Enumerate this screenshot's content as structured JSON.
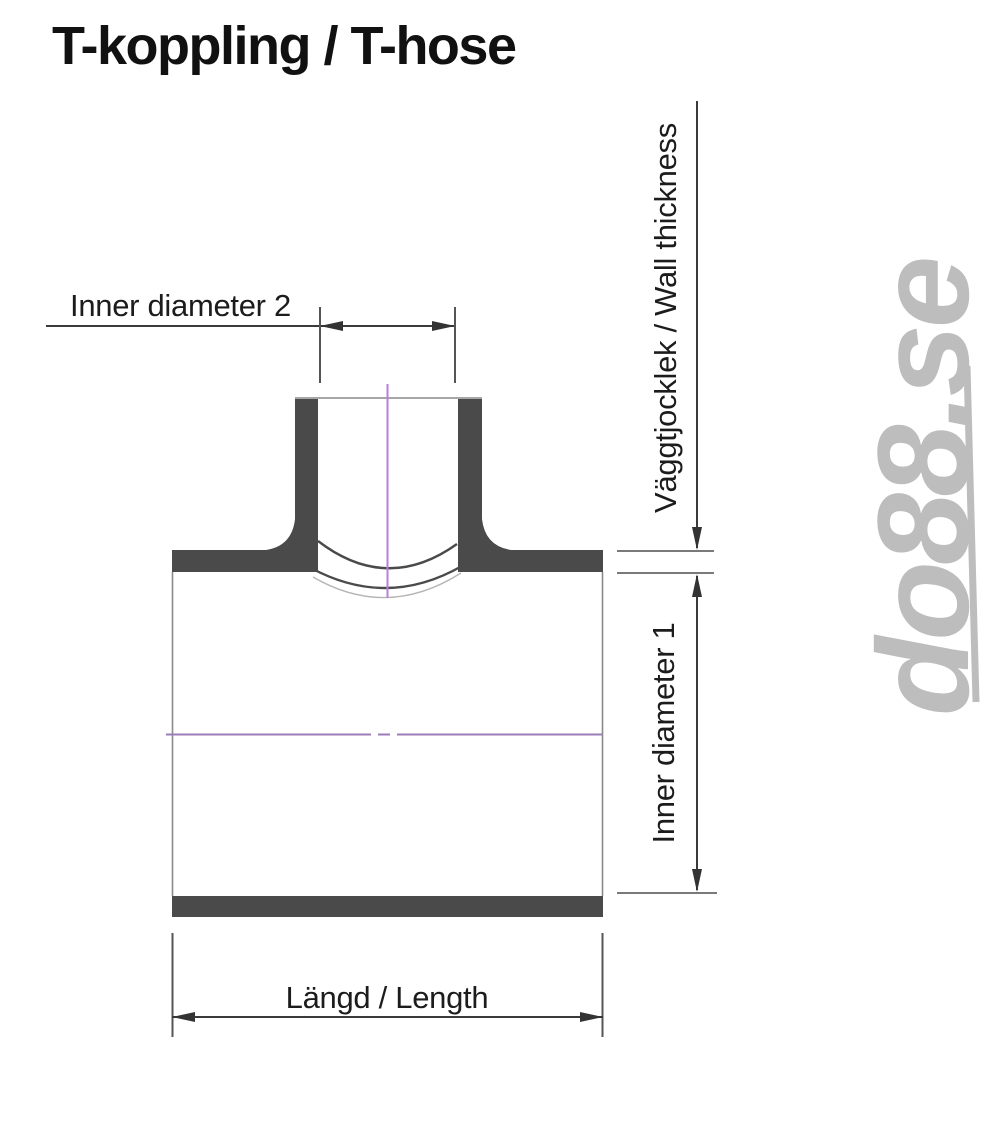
{
  "title": "T-koppling / T-hose",
  "dimensions": {
    "inner_diameter_2": {
      "label": "Inner diameter 2"
    },
    "wall_thickness": {
      "label": "Väggtjocklek / Wall thickness"
    },
    "inner_diameter_1": {
      "label": "Inner diameter 1"
    },
    "length": {
      "label": "Längd / Length"
    }
  },
  "watermark": {
    "text": "do88.se"
  },
  "colors": {
    "wall_fill": "#4a4a4a",
    "outline_gray": "#8a8a8a",
    "dimension_line": "#333333",
    "label_text": "#1c1c1c",
    "title_text": "#111111",
    "centerline_vertical": "#bb7fd8",
    "centerline_horizontal": "#9d7cba",
    "watermark_gray": "#bdbdbd",
    "background": "#ffffff"
  }
}
